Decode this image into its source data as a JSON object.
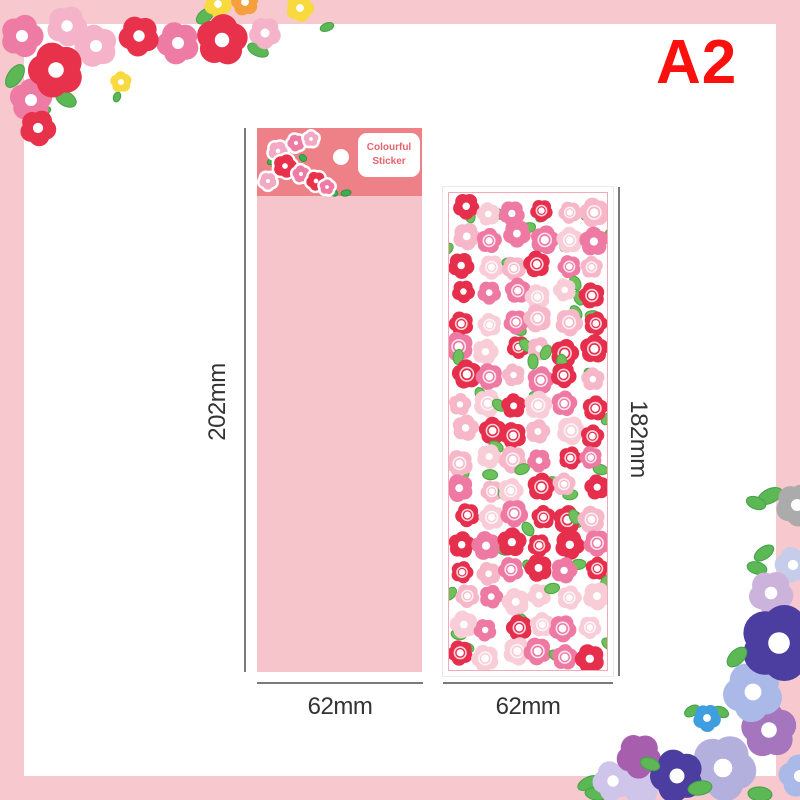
{
  "badge": "A2",
  "package": {
    "label_line1": "Colourful",
    "label_line2": "Sticker"
  },
  "dimensions": {
    "package_height": "202mm",
    "package_width": "62mm",
    "sheet_height": "182mm",
    "sheet_width": "62mm"
  },
  "colors": {
    "frame": "#f7c9ce",
    "badge": "#fb100d",
    "header": "#ee8187",
    "body": "#f6c5cb",
    "label": "#e6636e",
    "dim_line": "#7a7a7a",
    "dim_text": "#333333",
    "sheet_border": "#f2aab6"
  },
  "decor": {
    "top_left_garland": {
      "leaf_color": "#5cb855",
      "leaf_stroke": "#47a24a",
      "leaves": [
        {
          "x": 15,
          "y": 76,
          "rx": 13,
          "ry": 7,
          "rot": -55
        },
        {
          "x": 66,
          "y": 99,
          "rx": 11,
          "ry": 7,
          "rot": 30
        },
        {
          "x": 44,
          "y": 111,
          "rx": 7,
          "ry": 4,
          "rot": -20
        },
        {
          "x": 205,
          "y": 16,
          "rx": 10,
          "ry": 6,
          "rot": -40
        },
        {
          "x": 258,
          "y": 50,
          "rx": 11,
          "ry": 6,
          "rot": 25
        },
        {
          "x": 327,
          "y": 27,
          "rx": 7,
          "ry": 4,
          "rot": -20
        },
        {
          "x": 117,
          "y": 97,
          "rx": 5,
          "ry": 3.5,
          "rot": -70
        }
      ],
      "flowers": [
        {
          "x": 67,
          "y": 26,
          "r": 19,
          "c": "#f5b3ca",
          "rot": 10
        },
        {
          "x": 96,
          "y": 46,
          "r": 20,
          "c": "#f5b3ca",
          "rot": 40
        },
        {
          "x": 265,
          "y": 33,
          "r": 15,
          "c": "#f5b3ca",
          "rot": 20
        },
        {
          "x": 22,
          "y": 36,
          "r": 20,
          "c": "#ee7ba4",
          "rot": 0
        },
        {
          "x": 178,
          "y": 43,
          "r": 20,
          "c": "#ee7ba4",
          "rot": 30
        },
        {
          "x": 31,
          "y": 100,
          "r": 20,
          "c": "#ee7ba4",
          "rot": 55
        },
        {
          "x": 218,
          "y": 4,
          "r": 13,
          "c": "#f8d93e",
          "rot": 15
        },
        {
          "x": 245,
          "y": 2,
          "r": 13,
          "c": "#f5a03c",
          "rot": 45
        },
        {
          "x": 300,
          "y": 8,
          "r": 13,
          "c": "#f8d93e",
          "rot": 5
        },
        {
          "x": 139,
          "y": 36,
          "r": 19,
          "c": "#e8324c",
          "rot": 25
        },
        {
          "x": 222,
          "y": 40,
          "r": 24,
          "c": "#e8324c",
          "rot": 60
        },
        {
          "x": 56,
          "y": 70,
          "r": 26,
          "c": "#e8324c",
          "rot": 35
        },
        {
          "x": 38,
          "y": 128,
          "r": 17,
          "c": "#e8324c",
          "rot": 10
        },
        {
          "x": 121,
          "y": 82,
          "r": 10,
          "c": "#f8d93e",
          "rot": 50
        }
      ]
    },
    "bottom_right_garland": {
      "leaf_color": "#5cb855",
      "leaf_stroke": "#47a24a",
      "leaves_under": [
        {
          "x": 770,
          "y": 496,
          "rx": 13,
          "ry": 7,
          "rot": -25
        },
        {
          "x": 756,
          "y": 503,
          "rx": 10,
          "ry": 6,
          "rot": 20
        },
        {
          "x": 764,
          "y": 553,
          "rx": 11,
          "ry": 6,
          "rot": -35
        },
        {
          "x": 757,
          "y": 568,
          "rx": 10,
          "ry": 6,
          "rot": 15
        },
        {
          "x": 589,
          "y": 783,
          "rx": 12,
          "ry": 6,
          "rot": -25
        },
        {
          "x": 596,
          "y": 794,
          "rx": 11,
          "ry": 6,
          "rot": 10
        },
        {
          "x": 692,
          "y": 711,
          "rx": 8,
          "ry": 5,
          "rot": -30
        },
        {
          "x": 721,
          "y": 712,
          "rx": 8,
          "ry": 5,
          "rot": 25
        }
      ],
      "leaves_over": [
        {
          "x": 737,
          "y": 657,
          "rx": 12,
          "ry": 7,
          "rot": -45
        },
        {
          "x": 650,
          "y": 764,
          "rx": 10,
          "ry": 6,
          "rot": 20
        },
        {
          "x": 700,
          "y": 788,
          "rx": 12,
          "ry": 7,
          "rot": -10
        },
        {
          "x": 760,
          "y": 794,
          "rx": 12,
          "ry": 7,
          "rot": 5
        }
      ],
      "flowers": [
        {
          "x": 797,
          "y": 505,
          "r": 20,
          "c": "#ababab",
          "rot": 10
        },
        {
          "x": 793,
          "y": 565,
          "r": 17,
          "c": "#c5cdea",
          "rot": 40
        },
        {
          "x": 771,
          "y": 593,
          "r": 21,
          "c": "#cbb3dc",
          "rot": 15
        },
        {
          "x": 613,
          "y": 781,
          "r": 19,
          "c": "#cfc5ea",
          "rot": 30
        },
        {
          "x": 642,
          "y": 786,
          "r": 18,
          "c": "#cfc5ea",
          "rot": 60,
          "ctr": false
        },
        {
          "x": 639,
          "y": 756,
          "r": 21,
          "c": "#a75fad",
          "rot": 20,
          "ctr": false
        },
        {
          "x": 800,
          "y": 776,
          "r": 20,
          "c": "#aab9e8",
          "rot": 45
        },
        {
          "x": 723,
          "y": 768,
          "r": 31,
          "c": "#b4b0de",
          "rot": 10
        },
        {
          "x": 769,
          "y": 730,
          "r": 26,
          "c": "#a575bd",
          "rot": 50
        },
        {
          "x": 753,
          "y": 692,
          "r": 28,
          "c": "#aab9e8",
          "rot": 25
        },
        {
          "x": 779,
          "y": 643,
          "r": 36,
          "c": "#4c3da1",
          "rot": 0
        },
        {
          "x": 677,
          "y": 776,
          "r": 25,
          "c": "#4c3da1",
          "rot": 35
        },
        {
          "x": 707,
          "y": 718,
          "r": 13,
          "c": "#3f9ee0",
          "rot": 15
        }
      ]
    },
    "package_cluster": {
      "leaf_color": "#3fae4e",
      "leaf_stroke": "#2f9640",
      "leaves": [
        {
          "x": 272,
          "y": 161,
          "rx": 5,
          "ry": 3,
          "rot": -30
        },
        {
          "x": 303,
          "y": 158,
          "rx": 4,
          "ry": 3,
          "rot": 40
        },
        {
          "x": 334,
          "y": 193,
          "rx": 4,
          "ry": 3,
          "rot": 20
        },
        {
          "x": 346,
          "y": 193,
          "rx": 5,
          "ry": 3,
          "rot": -10
        }
      ],
      "flowers": [
        {
          "x": 278,
          "y": 151,
          "r": 9,
          "c": "#f2a9c4",
          "rot": 10,
          "outline": true
        },
        {
          "x": 296,
          "y": 143,
          "r": 8,
          "c": "#ee7ba4",
          "rot": 30,
          "outline": true
        },
        {
          "x": 311,
          "y": 139,
          "r": 7,
          "c": "#f2a9c4",
          "rot": 55,
          "outline": true
        },
        {
          "x": 268,
          "y": 181,
          "r": 8,
          "c": "#f2a9c4",
          "rot": 20,
          "outline": true
        },
        {
          "x": 285,
          "y": 166,
          "r": 11,
          "c": "#e8324c",
          "rot": 0,
          "outline": true
        },
        {
          "x": 301,
          "y": 174,
          "r": 8,
          "c": "#ee7ba4",
          "rot": 45,
          "outline": true
        },
        {
          "x": 316,
          "y": 181,
          "r": 9,
          "c": "#e8324c",
          "rot": 25,
          "outline": true
        },
        {
          "x": 327,
          "y": 187,
          "r": 7,
          "c": "#ee7ba4",
          "rot": 60,
          "outline": true
        }
      ]
    },
    "sheet_pattern": {
      "cols": 6,
      "rows": 17,
      "x0": 450,
      "y0": 196,
      "cell_w": 26,
      "cell_h": 27.8,
      "min_r": 10.5,
      "max_r": 14,
      "jitter": 9,
      "colors": [
        "#e62e4d",
        "#ee7aa3",
        "#f6b7c8",
        "#f9cdd7"
      ],
      "leaf_color": "#6cc15a",
      "leaf_stroke": "#4ea846",
      "leaf_prob": 0.55
    }
  }
}
